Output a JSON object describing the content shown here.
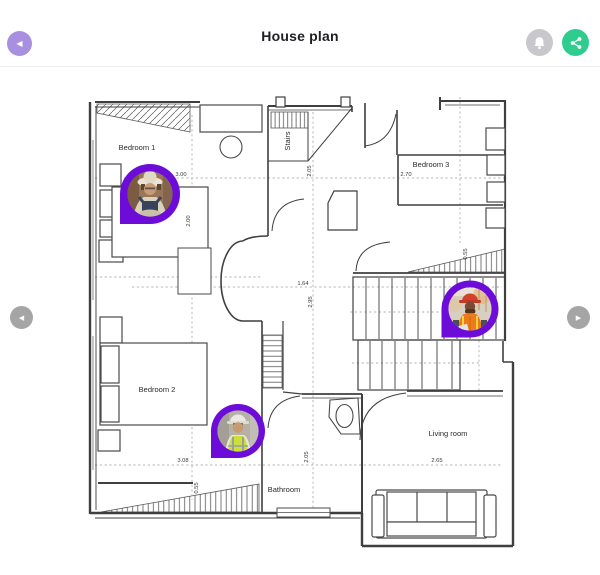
{
  "header": {
    "title": "House plan",
    "back_icon": "chevron-left",
    "bell_icon": "notification-bell",
    "share_icon": "share-network"
  },
  "navigation": {
    "prev_icon": "chevron-left-circle",
    "next_icon": "chevron-right-circle"
  },
  "colors": {
    "back_button_purple": "#a88fe0",
    "pin_purple": "#6d0bd8",
    "share_green": "#2ecd8f",
    "bell_gray": "#c7c7cc",
    "nav_gray": "#a5a5a5",
    "wall_gray": "#3f3f3f"
  },
  "plan": {
    "rooms": [
      {
        "label": "Bedroom 1"
      },
      {
        "label": "Stairs"
      },
      {
        "label": "Bedroom 3"
      },
      {
        "label": "Bedroom 2"
      },
      {
        "label": "Bathroom"
      },
      {
        "label": "Living room"
      }
    ],
    "dimensions": [
      {
        "value": "3.00",
        "area": "Bedroom 1"
      },
      {
        "value": "2.00",
        "area": "Bedroom 1"
      },
      {
        "value": "2.05",
        "area": "Stairs"
      },
      {
        "value": "2.70",
        "area": "Bedroom 3"
      },
      {
        "value": "1.64",
        "area": "Hall"
      },
      {
        "value": "2.95",
        "area": "Hall"
      },
      {
        "value": "0.55",
        "area": "Staircase"
      },
      {
        "value": "3.08",
        "area": "Bedroom 2"
      },
      {
        "value": "0.55",
        "area": "Bedroom 2"
      },
      {
        "value": "2.05",
        "area": "Bathroom"
      },
      {
        "value": "2.65",
        "area": "Living room"
      }
    ],
    "workers": [
      {
        "avatar": "woman-worker-overalls",
        "location": "Bedroom 1"
      },
      {
        "avatar": "man-worker-orange-vest",
        "location": "Staircase"
      },
      {
        "avatar": "man-worker-yellow-vest",
        "location": "Bathroom corridor"
      }
    ]
  }
}
